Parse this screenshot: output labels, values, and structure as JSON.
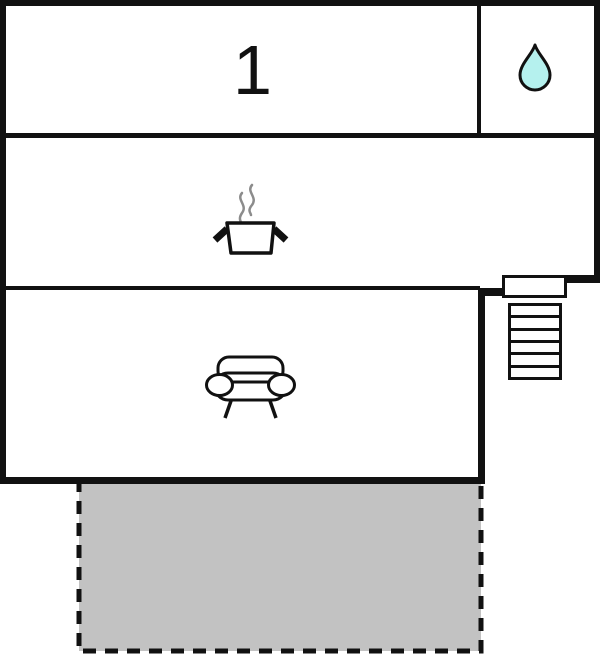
{
  "floor_plan": {
    "level_label": "1",
    "rooms": [
      {
        "id": "bedroom-1",
        "label": "1"
      },
      {
        "id": "bathroom",
        "icon": "water-drop-icon"
      },
      {
        "id": "kitchen",
        "icon": "cooking-pot-icon"
      },
      {
        "id": "living-room",
        "icon": "sofa-icon"
      },
      {
        "id": "terrace",
        "appearance": "gray-fill-dashed-outline"
      }
    ],
    "features": [
      {
        "id": "entrance-door",
        "icon": "door-rectangle"
      },
      {
        "id": "staircase",
        "icon": "stairs-icon",
        "steps": 6
      }
    ],
    "colors": {
      "wall": "#111111",
      "background": "#ffffff",
      "water_drop_fill": "#b5f1ee",
      "terrace_fill": "#c2c2c2",
      "steam": "#8c8c8c",
      "outline": "#111111"
    }
  }
}
